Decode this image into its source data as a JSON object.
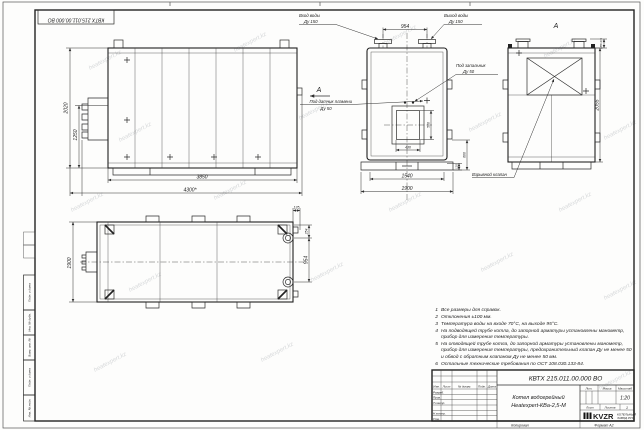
{
  "watermark": "heatexpert.kz",
  "frame": {
    "stamp_top_left": "КВТХ 215.011.00.000 ВО",
    "margin_labels": [
      "Подп. и дата",
      "Инв. № дубл.",
      "Взам. инв. №",
      "Подп. и дата",
      "Инв. № подл."
    ],
    "copied": "Копировал",
    "format": "Формат А2"
  },
  "front_view": {
    "dim_height_outer": "2020",
    "dim_height_inner": "1250",
    "dim_width_inner": "3850",
    "dim_width_outer": "4300*"
  },
  "section_view": {
    "inlet_line1": "Вход воды",
    "inlet_line2": "Ду 150",
    "outlet_line1": "Выход воды",
    "outlet_line2": "Ду 150",
    "dim_pipes": "954",
    "igniter_line1": "Под запальник",
    "igniter_line2": "Ду 50",
    "flame_line1": "Под датчик пламени",
    "flame_line2": "Ду 50",
    "view_letter": "А",
    "dim_opening_w": "480",
    "dim_opening_h": "560",
    "dim_base": "1540",
    "dim_width": "1900",
    "dim_right_small": "135",
    "dim_right_mid": "600"
  },
  "side_view": {
    "view_label": "А",
    "valve_label": "Взрывной клапан",
    "dim_top": "185±0,5",
    "dim_height": "2055"
  },
  "plan_view": {
    "dim_width": "1900",
    "dim_offset": "135",
    "dim_edge": "254",
    "dim_pipes": "954"
  },
  "notes": [
    {
      "n": "1",
      "text": "Все размеры для справок."
    },
    {
      "n": "2",
      "text": "Отклонения ±100 мм."
    },
    {
      "n": "3",
      "text": "Температура воды на входе 70°С, на выходе 95°С."
    },
    {
      "n": "4",
      "text": "На подводящей трубе котла, до запорной арматуры установлены манометр, прибор для измерения температуры."
    },
    {
      "n": "5",
      "text": "На отводящей трубе котла, до запорной арматуры установлены манометр, прибор для измерения температуры, предохранительный клапан Ду не менее 50 и обвод с обратным клапаном Ду не менее 50 мм."
    },
    {
      "n": "6",
      "text": "Остальные технические требования по ОСТ 108.030.133-84."
    }
  ],
  "title_block": {
    "doc_number": "КВТХ 215.011.00.000 ВО",
    "name_line1": "Котел водогрейный",
    "name_line2": "Heatexpert-КВа-2,5-М",
    "cols": [
      "Изм.",
      "Лист",
      "№ докум.",
      "Подп.",
      "Дата"
    ],
    "rows": [
      "Разраб.",
      "Пров.",
      "Т.контр.",
      "",
      "Н.контр.",
      "Утв."
    ],
    "lit": "Лит.",
    "mass": "Масса",
    "scale": "Масштаб",
    "scale_value": "1:20",
    "sheet": "Лист",
    "sheets": "Листов",
    "sheets_value": "1",
    "logo": "KVZR",
    "company_line1": "КОТЕЛЬНЫЙ",
    "company_line2": "ЗАВОД.РУС"
  }
}
